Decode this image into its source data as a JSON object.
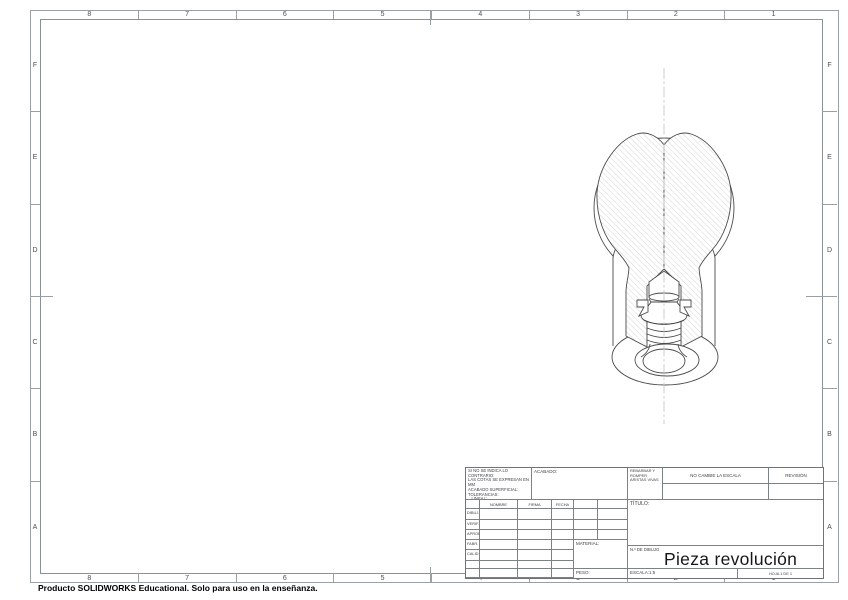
{
  "sheet": {
    "zones_top": [
      "8",
      "7",
      "6",
      "5",
      "4",
      "3",
      "2",
      "1"
    ],
    "zones_bottom": [
      "8",
      "7",
      "6",
      "5",
      "4",
      "3",
      "2",
      "1"
    ],
    "zones_left": [
      "F",
      "E",
      "D",
      "C",
      "B",
      "A"
    ],
    "zones_right": [
      "F",
      "E",
      "D",
      "C",
      "B",
      "A"
    ],
    "footer_note": "Producto SOLIDWORKS Educational. Solo para uso en la enseñanza."
  },
  "title_block": {
    "tolerance_lines": [
      "SI NO SE INDICA LO CONTRARIO:",
      "LAS COTAS SE EXPRESAN EN MM",
      "ACABADO SUPERFICIAL:",
      "TOLERANCIAS:",
      "   LINEAL:",
      "   ANGULAR:"
    ],
    "finish_label": "ACABADO:",
    "deburr_note": "REBARBAR Y ROMPER ARISTAS VIVAS",
    "scale_warning": "NO CAMBIE LA ESCALA",
    "revision_label": "REVISIÓN",
    "signature_table": {
      "headers": [
        "NOMBRE",
        "FIRMA",
        "FECHA"
      ],
      "row_labels": [
        "DIBUJ.",
        "VERIF.",
        "APROB.",
        "FABR.",
        "CALID."
      ]
    },
    "material_label": "MATERIAL:",
    "weight_label": "PESO:",
    "title_label": "TÍTULO:",
    "drawing_no_label": "N.º DE DIBUJO",
    "drawing_title": "Pieza revolución",
    "sheet_format": "A3",
    "scale_value": "ESCALA:1:5",
    "sheet_value": "HOJA 1 DE 1"
  },
  "drawing_view": {
    "view_name": "section-view-revolved-part",
    "colors": {
      "outline": "#4a4a4a",
      "hatch": "#b4b4b4",
      "centerline": "#c6ccc0",
      "border": "#9aa0a3"
    }
  }
}
